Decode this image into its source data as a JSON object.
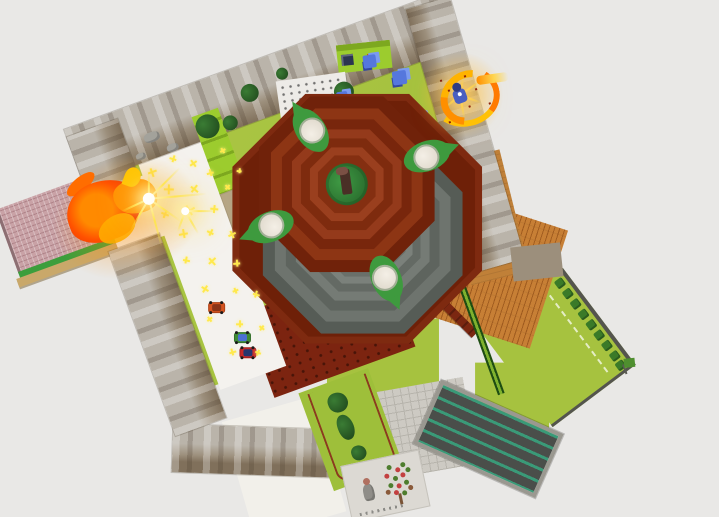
{
  "palette": {
    "void": "#e9e8e6",
    "grass": "#a6c23f",
    "path": "#f4f2ee",
    "wall_light": "#bab4aa",
    "wall_mid": "#9c8f7c",
    "wall_dark": "#80705b",
    "pink": "#c9a2a6",
    "pink_green": "#3c9e3c",
    "tan_edge": "#c9a86a",
    "roof": "#c77f35",
    "roof_line": "#a05c20",
    "floor_tan": "#c08038",
    "plaza": "#cdcac3",
    "plaza_line": "#b7b4ac",
    "dark_roof": "#4a4e4a",
    "teal_stripe": "#3a9a78",
    "frame": "#9a9890",
    "garden": "#9ebf3a",
    "garden_line": "#8b3a1f",
    "card": "#dcd9d3",
    "lime": "#9ccc2e",
    "lime_dark": "#7da81f",
    "white_building": "#edebe7",
    "bush": "#2e6b2e",
    "crystal": "#5577dd",
    "fire_core": "#ff8a00",
    "fire_deep": "#f03800",
    "fire_mid": "#ff9100",
    "fire_tip": "#ffc400",
    "spark": "#ffe94d",
    "carpet": "#c11616",
    "beam": "#7b2711",
    "pole_dark": "#1e4d12",
    "pole_light": "#7fb22e",
    "fence": "#54544e",
    "white_block": "#f2f0ea",
    "base_red": "#7c2410",
    "rim_red": "#7e2a10",
    "green_center": "#338a38",
    "stump": "#4a2f26",
    "pod_leaf": "#3e9a3e",
    "tree_green": "#4e7d2e",
    "tree_red": "#c34040",
    "tree_brown": "#8a5a3a"
  },
  "scene": {
    "viewport": {
      "width": 719,
      "height": 517
    },
    "map_rotation_deg": -20,
    "tower": {
      "rim": {
        "cx": 231,
        "cy": 170,
        "size": 250,
        "color": "#7e2a10",
        "inner_color": "#6e2008"
      },
      "gray_rings": {
        "cx": 231,
        "cy": 186,
        "sizes": [
          200,
          176,
          154,
          134,
          116,
          100,
          86
        ],
        "colors": [
          "#565c56",
          "#6e746e",
          "#5e645e",
          "#757b75",
          "#646a64",
          "#7b817b",
          "#6a706a"
        ]
      },
      "red_rings": {
        "cx": 233,
        "cy": 134,
        "sizes": [
          176,
          152,
          130,
          110,
          92,
          74,
          58
        ],
        "colors": [
          "#70220a",
          "#8d3514",
          "#78260c",
          "#943a1b",
          "#7e2b0e",
          "#9a3f1e",
          "#842f11"
        ]
      },
      "pods": [
        {
          "x": 217,
          "y": 68,
          "a": -103
        },
        {
          "x": 321,
          "y": 135,
          "a": 0
        },
        {
          "x": 144,
          "y": 148,
          "a": 178
        },
        {
          "x": 238,
          "y": 239,
          "a": 87
        }
      ]
    },
    "enemies": [
      {
        "x": 60,
        "y": 199,
        "body": "#d4531f",
        "roof": "#8a3417"
      },
      {
        "x": 74,
        "y": 236,
        "body": "#3f8b35",
        "roof": "#4a6fd4"
      },
      {
        "x": 74,
        "y": 252,
        "body": "#c62828",
        "roof": "#26356e"
      }
    ],
    "sparkles": [
      {
        "x": 54,
        "y": 56,
        "s": 9
      },
      {
        "x": 78,
        "y": 50,
        "s": 7
      },
      {
        "x": 96,
        "y": 62,
        "s": 8
      },
      {
        "x": 64,
        "y": 78,
        "s": 10
      },
      {
        "x": 88,
        "y": 86,
        "s": 9
      },
      {
        "x": 108,
        "y": 76,
        "s": 7
      },
      {
        "x": 52,
        "y": 100,
        "s": 8
      },
      {
        "x": 76,
        "y": 104,
        "s": 11
      },
      {
        "x": 100,
        "y": 112,
        "s": 8
      },
      {
        "x": 120,
        "y": 96,
        "s": 6
      },
      {
        "x": 62,
        "y": 124,
        "s": 9
      },
      {
        "x": 88,
        "y": 132,
        "s": 7
      },
      {
        "x": 108,
        "y": 142,
        "s": 8
      },
      {
        "x": 56,
        "y": 150,
        "s": 7
      },
      {
        "x": 80,
        "y": 160,
        "s": 9
      },
      {
        "x": 102,
        "y": 170,
        "s": 7
      },
      {
        "x": 64,
        "y": 184,
        "s": 8
      },
      {
        "x": 92,
        "y": 196,
        "s": 6
      },
      {
        "x": 110,
        "y": 206,
        "s": 7
      },
      {
        "x": 58,
        "y": 214,
        "s": 6
      },
      {
        "x": 84,
        "y": 228,
        "s": 7
      },
      {
        "x": 104,
        "y": 240,
        "s": 6
      },
      {
        "x": 68,
        "y": 252,
        "s": 7
      },
      {
        "x": 92,
        "y": 262,
        "s": 6
      },
      {
        "x": 128,
        "y": 60,
        "s": 6
      },
      {
        "x": 136,
        "y": 84,
        "s": 5
      }
    ],
    "top_bushes": [
      {
        "x": 173,
        "y": 15,
        "d": 18
      },
      {
        "x": 144,
        "y": 36,
        "d": 15
      },
      {
        "x": 262,
        "y": 46,
        "d": 20
      },
      {
        "x": 299,
        "y": 77,
        "d": 16
      },
      {
        "x": 210,
        "y": 8,
        "d": 12
      },
      {
        "x": 122,
        "y": 32,
        "d": 24
      },
      {
        "x": 208,
        "y": 66,
        "d": 13
      },
      {
        "x": 181,
        "y": 68,
        "d": 11
      }
    ],
    "garden_bushes": [
      {
        "x": 150,
        "y": 336,
        "w": 20,
        "h": 20
      },
      {
        "x": 149,
        "y": 362,
        "w": 16,
        "h": 26
      },
      {
        "x": 152,
        "y": 390,
        "w": 15,
        "h": 15
      }
    ],
    "fence_bushes": [
      {
        "x": 88,
        "y": 6
      },
      {
        "x": 88,
        "y": 19
      },
      {
        "x": 88,
        "y": 32
      },
      {
        "x": 88,
        "y": 45
      },
      {
        "x": 88,
        "y": 58
      },
      {
        "x": 88,
        "y": 71
      },
      {
        "x": 88,
        "y": 84
      },
      {
        "x": 88,
        "y": 97
      },
      {
        "x": 87,
        "y": 108
      }
    ],
    "crystals": [
      {
        "x": 296,
        "y": 26,
        "d": 13
      },
      {
        "x": 258,
        "y": 50,
        "d": 11
      },
      {
        "x": 297,
        "y": 96,
        "d": 12
      },
      {
        "x": 319,
        "y": 52,
        "d": 14
      },
      {
        "x": 324,
        "y": 97,
        "d": 10
      }
    ],
    "rocks": [
      {
        "x": 58,
        "y": 18,
        "w": 16,
        "h": 10
      },
      {
        "x": 76,
        "y": 36,
        "w": 12,
        "h": 8
      },
      {
        "x": 44,
        "y": 34,
        "w": 10,
        "h": 7
      }
    ],
    "tree_dots": [
      {
        "x": 44,
        "y": 8,
        "c": "g"
      },
      {
        "x": 52,
        "y": 12,
        "c": "r"
      },
      {
        "x": 58,
        "y": 8,
        "c": "g"
      },
      {
        "x": 40,
        "y": 16,
        "c": "r"
      },
      {
        "x": 48,
        "y": 20,
        "c": "g"
      },
      {
        "x": 56,
        "y": 18,
        "c": "r"
      },
      {
        "x": 62,
        "y": 14,
        "c": "g"
      },
      {
        "x": 42,
        "y": 26,
        "c": "g"
      },
      {
        "x": 50,
        "y": 28,
        "c": "r"
      },
      {
        "x": 58,
        "y": 26,
        "c": "g"
      },
      {
        "x": 46,
        "y": 34,
        "c": "r"
      },
      {
        "x": 54,
        "y": 36,
        "c": "g"
      },
      {
        "x": 38,
        "y": 32,
        "c": "b"
      },
      {
        "x": 61,
        "y": 32,
        "c": "b"
      }
    ],
    "effects": {
      "burst_main": {
        "x": 42,
        "y": 80,
        "rays": [
          {
            "a": -25,
            "l": 44
          },
          {
            "a": 15,
            "l": 58
          },
          {
            "a": 55,
            "l": 40
          },
          {
            "a": 95,
            "l": 50
          },
          {
            "a": 140,
            "l": 36
          },
          {
            "a": 175,
            "l": 30
          },
          {
            "a": -70,
            "l": 26
          }
        ]
      },
      "burst_small": {
        "x": 72,
        "y": 104,
        "rays": [
          {
            "a": 20,
            "l": 30
          },
          {
            "a": 80,
            "l": 26
          },
          {
            "a": 130,
            "l": 22
          }
        ]
      },
      "explosion": {
        "x": 370,
        "y": 89,
        "rays": [
          {
            "a": -15,
            "l": 26
          },
          {
            "a": 40,
            "l": 22
          },
          {
            "a": 100,
            "l": 24
          },
          {
            "a": 160,
            "l": 20
          },
          {
            "a": -60,
            "l": 18
          },
          {
            "a": -120,
            "l": 22
          }
        ]
      }
    }
  }
}
